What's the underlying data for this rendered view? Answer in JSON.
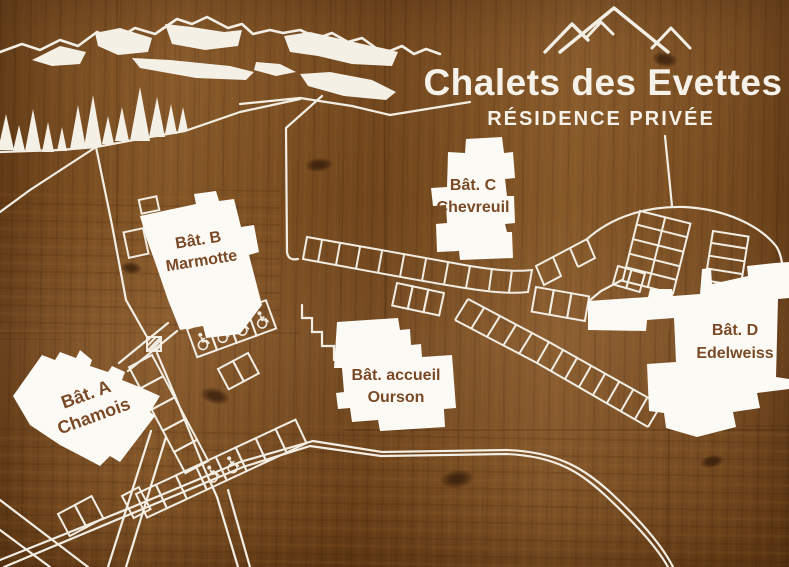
{
  "sign": {
    "title": "Chalets des Evettes",
    "subtitle": "RÉSIDENCE PRIVÉE"
  },
  "buildings": [
    {
      "id": "A",
      "line1": "Bât. A",
      "line2": "Chamois"
    },
    {
      "id": "B",
      "line1": "Bât. B",
      "line2": "Marmotte"
    },
    {
      "id": "C",
      "line1": "Bât. C",
      "line2": "Chevreuil"
    },
    {
      "id": "accueil",
      "line1": "Bât. accueil",
      "line2": "Ourson"
    },
    {
      "id": "D",
      "line1": "Bât. D",
      "line2": "Edelweiss"
    }
  ],
  "icons": {
    "mountain_peaks": "three-peaks-logo",
    "wheelchair": "♿",
    "trees": "fir-tree-silhouettes",
    "mountains": "snowy-ridge-silhouette"
  },
  "parking": {
    "accessible_spaces_building_b": 4,
    "accessible_spaces_south_row": 2
  },
  "colors": {
    "wood_brown": "#7d4f21",
    "art_white": "#f3eee4",
    "building_fill": "#fcfaf5",
    "label_brown": "#7a4a26",
    "title_white": "#f6f2e9"
  }
}
